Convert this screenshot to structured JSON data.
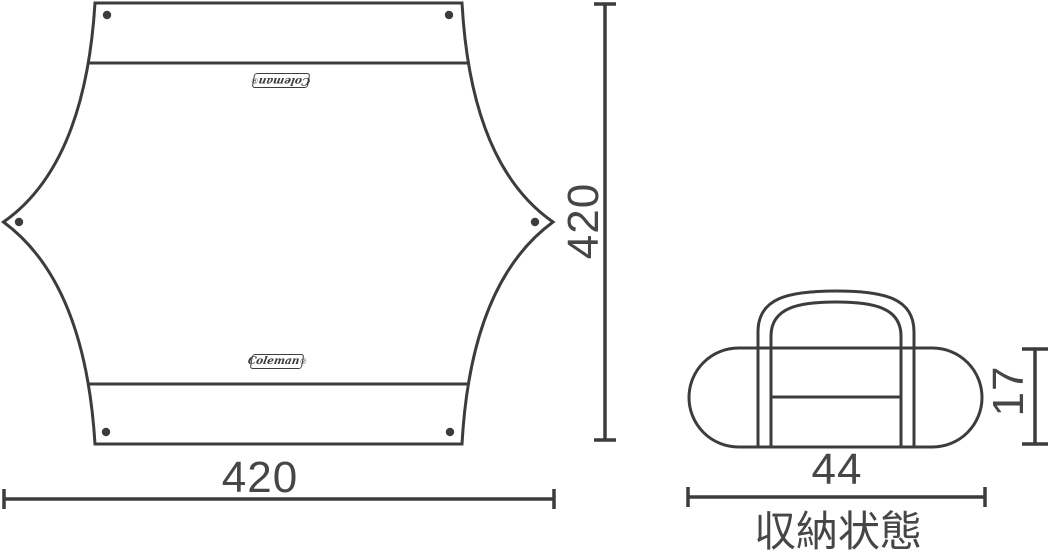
{
  "tarp": {
    "logo_text": "Coleman",
    "logo_mark": "®",
    "width_label": "420",
    "height_label": "420"
  },
  "bag": {
    "width_label": "44",
    "height_label": "17",
    "caption": "収納状態"
  },
  "colors": {
    "line": "#3c3c3c",
    "text": "#464646",
    "background": "#ffffff"
  }
}
